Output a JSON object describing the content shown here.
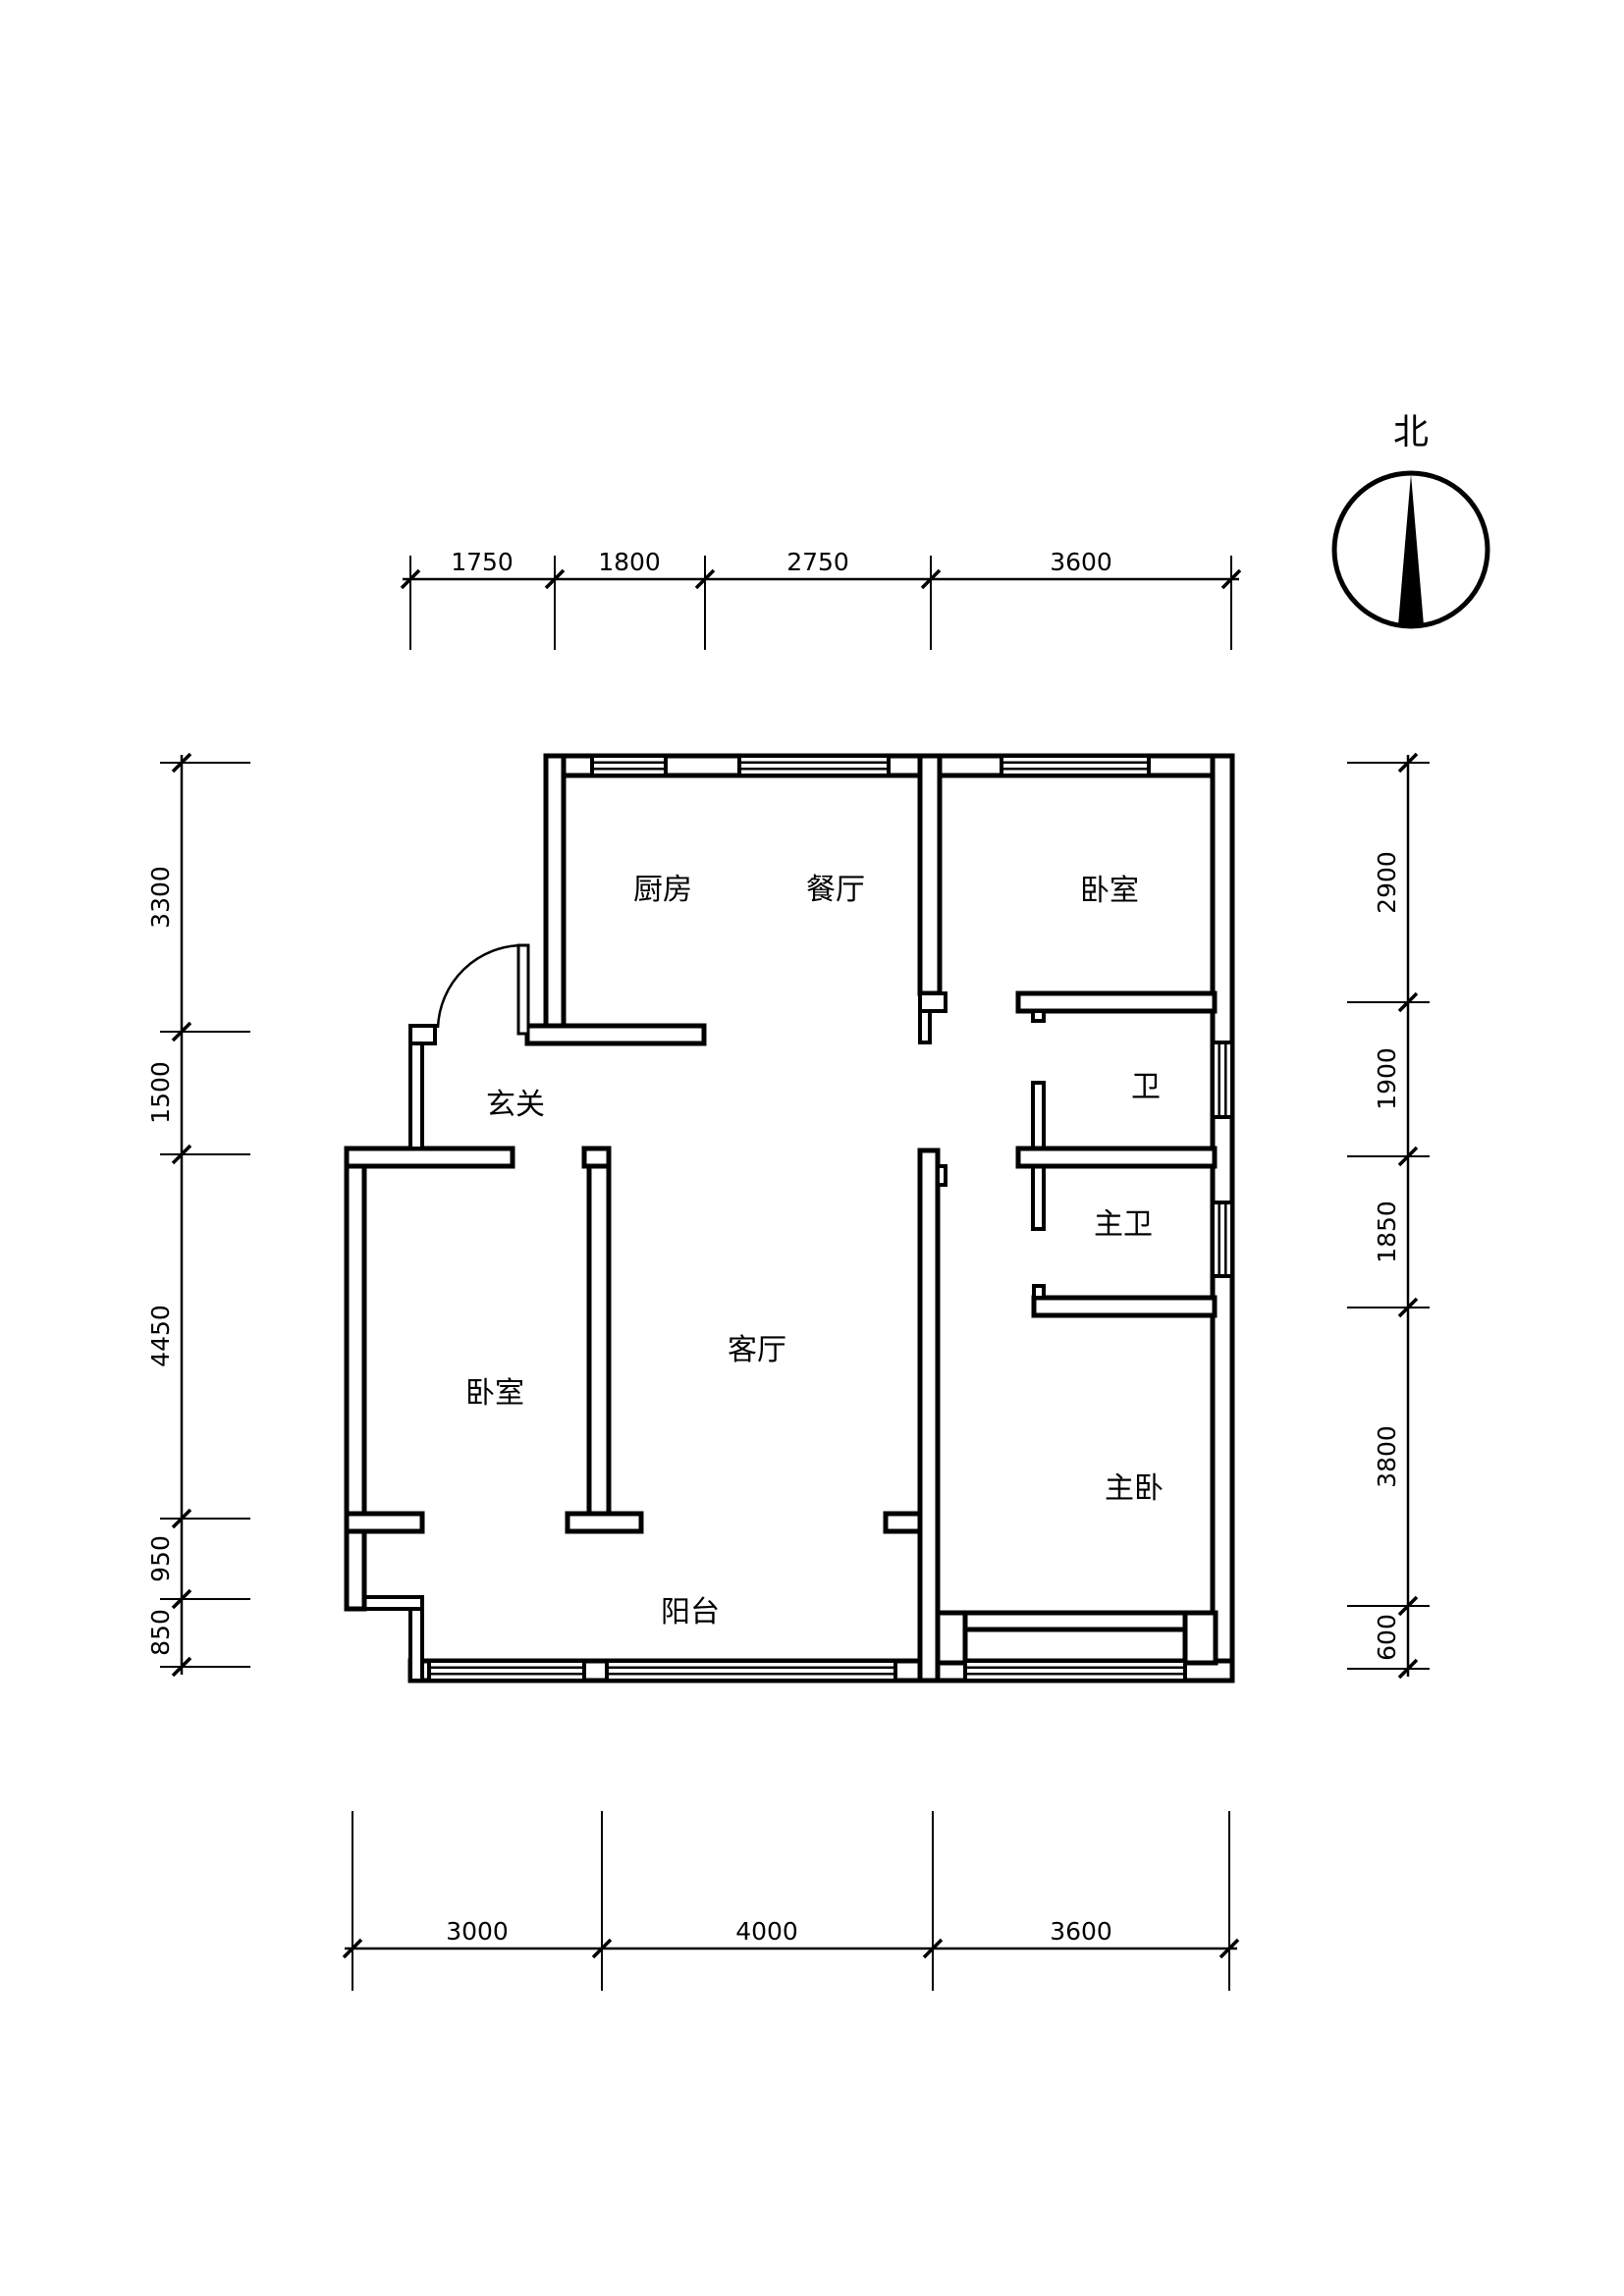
{
  "drawing": {
    "type": "apartment floor plan",
    "background_color": "#ffffff",
    "line_color": "#000000"
  },
  "compass": {
    "north_label": "北"
  },
  "rooms": {
    "kitchen": "厨房",
    "dining": "餐厅",
    "bedroom_ne": "卧室",
    "entry": "玄关",
    "bath": "卫",
    "master_bath": "主卫",
    "living": "客厅",
    "bedroom_w": "卧室",
    "master_bedroom": "主卧",
    "balcony": "阳台"
  },
  "dimensions": {
    "top": [
      "1750",
      "1800",
      "2750",
      "3600"
    ],
    "bottom": [
      "3000",
      "4000",
      "3600"
    ],
    "left": [
      "3300",
      "1500",
      "4450",
      "950",
      "850"
    ],
    "right": [
      "2900",
      "1900",
      "1850",
      "3800",
      "600"
    ]
  }
}
